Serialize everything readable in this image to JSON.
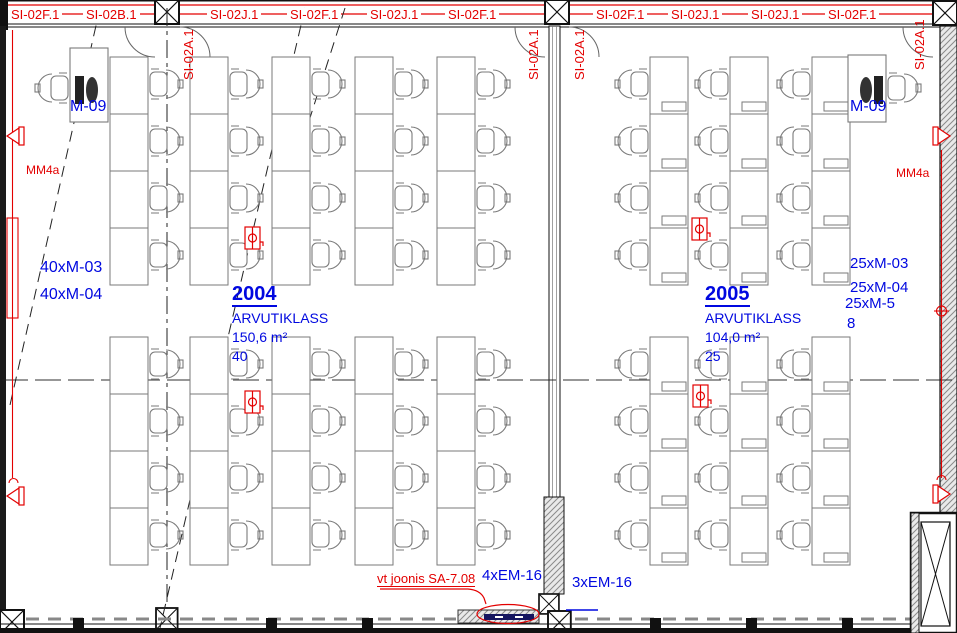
{
  "colors": {
    "annotation_red": "#e30000",
    "annotation_blue": "#0008e0",
    "fixture_navy": "#151560",
    "desk_gray": "#7a7a7a"
  },
  "plan": {
    "top_labels": [
      "SI-02F.1",
      "SI-02B.1",
      "SI-02J.1",
      "SI-02F.1",
      "SI-02J.1",
      "SI-02F.1",
      "SI-02F.1",
      "SI-02J.1",
      "SI-02J.1",
      "SI-02F.1"
    ],
    "vertical_labels": [
      "SI-02A.1",
      "SI-02A.1",
      "SI-02A.1",
      "SI-02A.1"
    ],
    "rooms": [
      {
        "number": "2004",
        "name": "ARVUTIKLASS",
        "area": "150,6 m²",
        "seats": "40",
        "teacher_station": "M-09",
        "equipment": [
          "40xM-03",
          "40xM-04"
        ]
      },
      {
        "number": "2005",
        "name": "ARVUTIKLASS",
        "area": "104,0 m²",
        "seats": "25",
        "teacher_station": "M-09",
        "equipment": [
          "25xM-03",
          "25xM-04",
          "25xM-5",
          "8"
        ]
      }
    ],
    "wall_labels": {
      "left": "MM4a",
      "right": "MM4a"
    },
    "bottom": {
      "reference_note": "vt joonis SA-7.08",
      "em16_left": "4xEM-16",
      "em16_right": "3xEM-16"
    }
  }
}
